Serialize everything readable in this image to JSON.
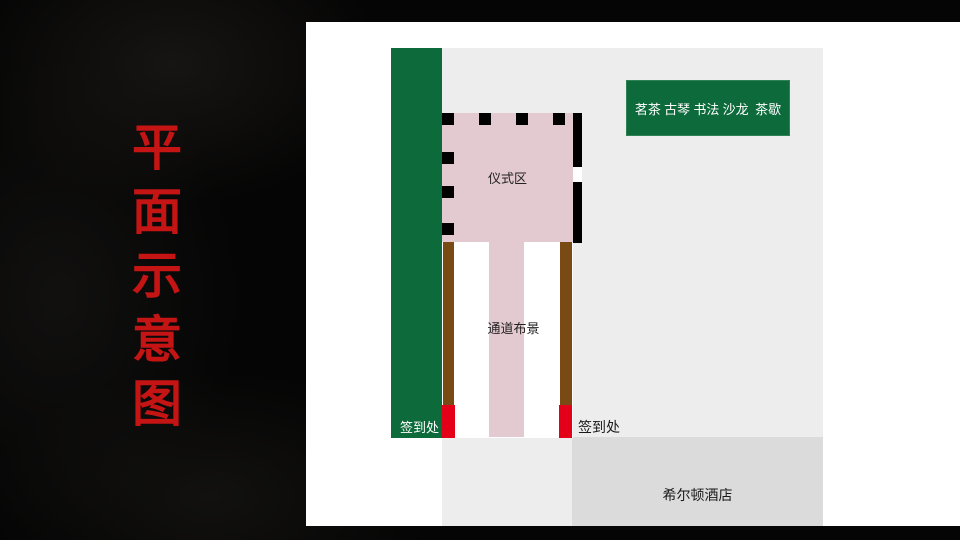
{
  "slide": {
    "title": "平面示意图"
  },
  "plan": {
    "info_board": {
      "label": "茗茶 古琴 书法 沙龙  茶歇"
    },
    "ceremony_area": {
      "label": "仪式区"
    },
    "aisle": {
      "label": "通道布景"
    },
    "signin_left": {
      "label": "签到处"
    },
    "signin_right": {
      "label": "签到处"
    },
    "hotel": {
      "label": "希尔顿酒店"
    }
  },
  "colors": {
    "title_red": "#c41414",
    "stage_green": "#0d6a3b",
    "area_pink": "#e3c9d0",
    "rail_brown": "#7a4a15",
    "signin_red": "#e50019",
    "diagram_gray": "#ededed",
    "hotel_gray": "#dbdbdb",
    "panel_white": "#ffffff",
    "background_black": "#050505"
  }
}
